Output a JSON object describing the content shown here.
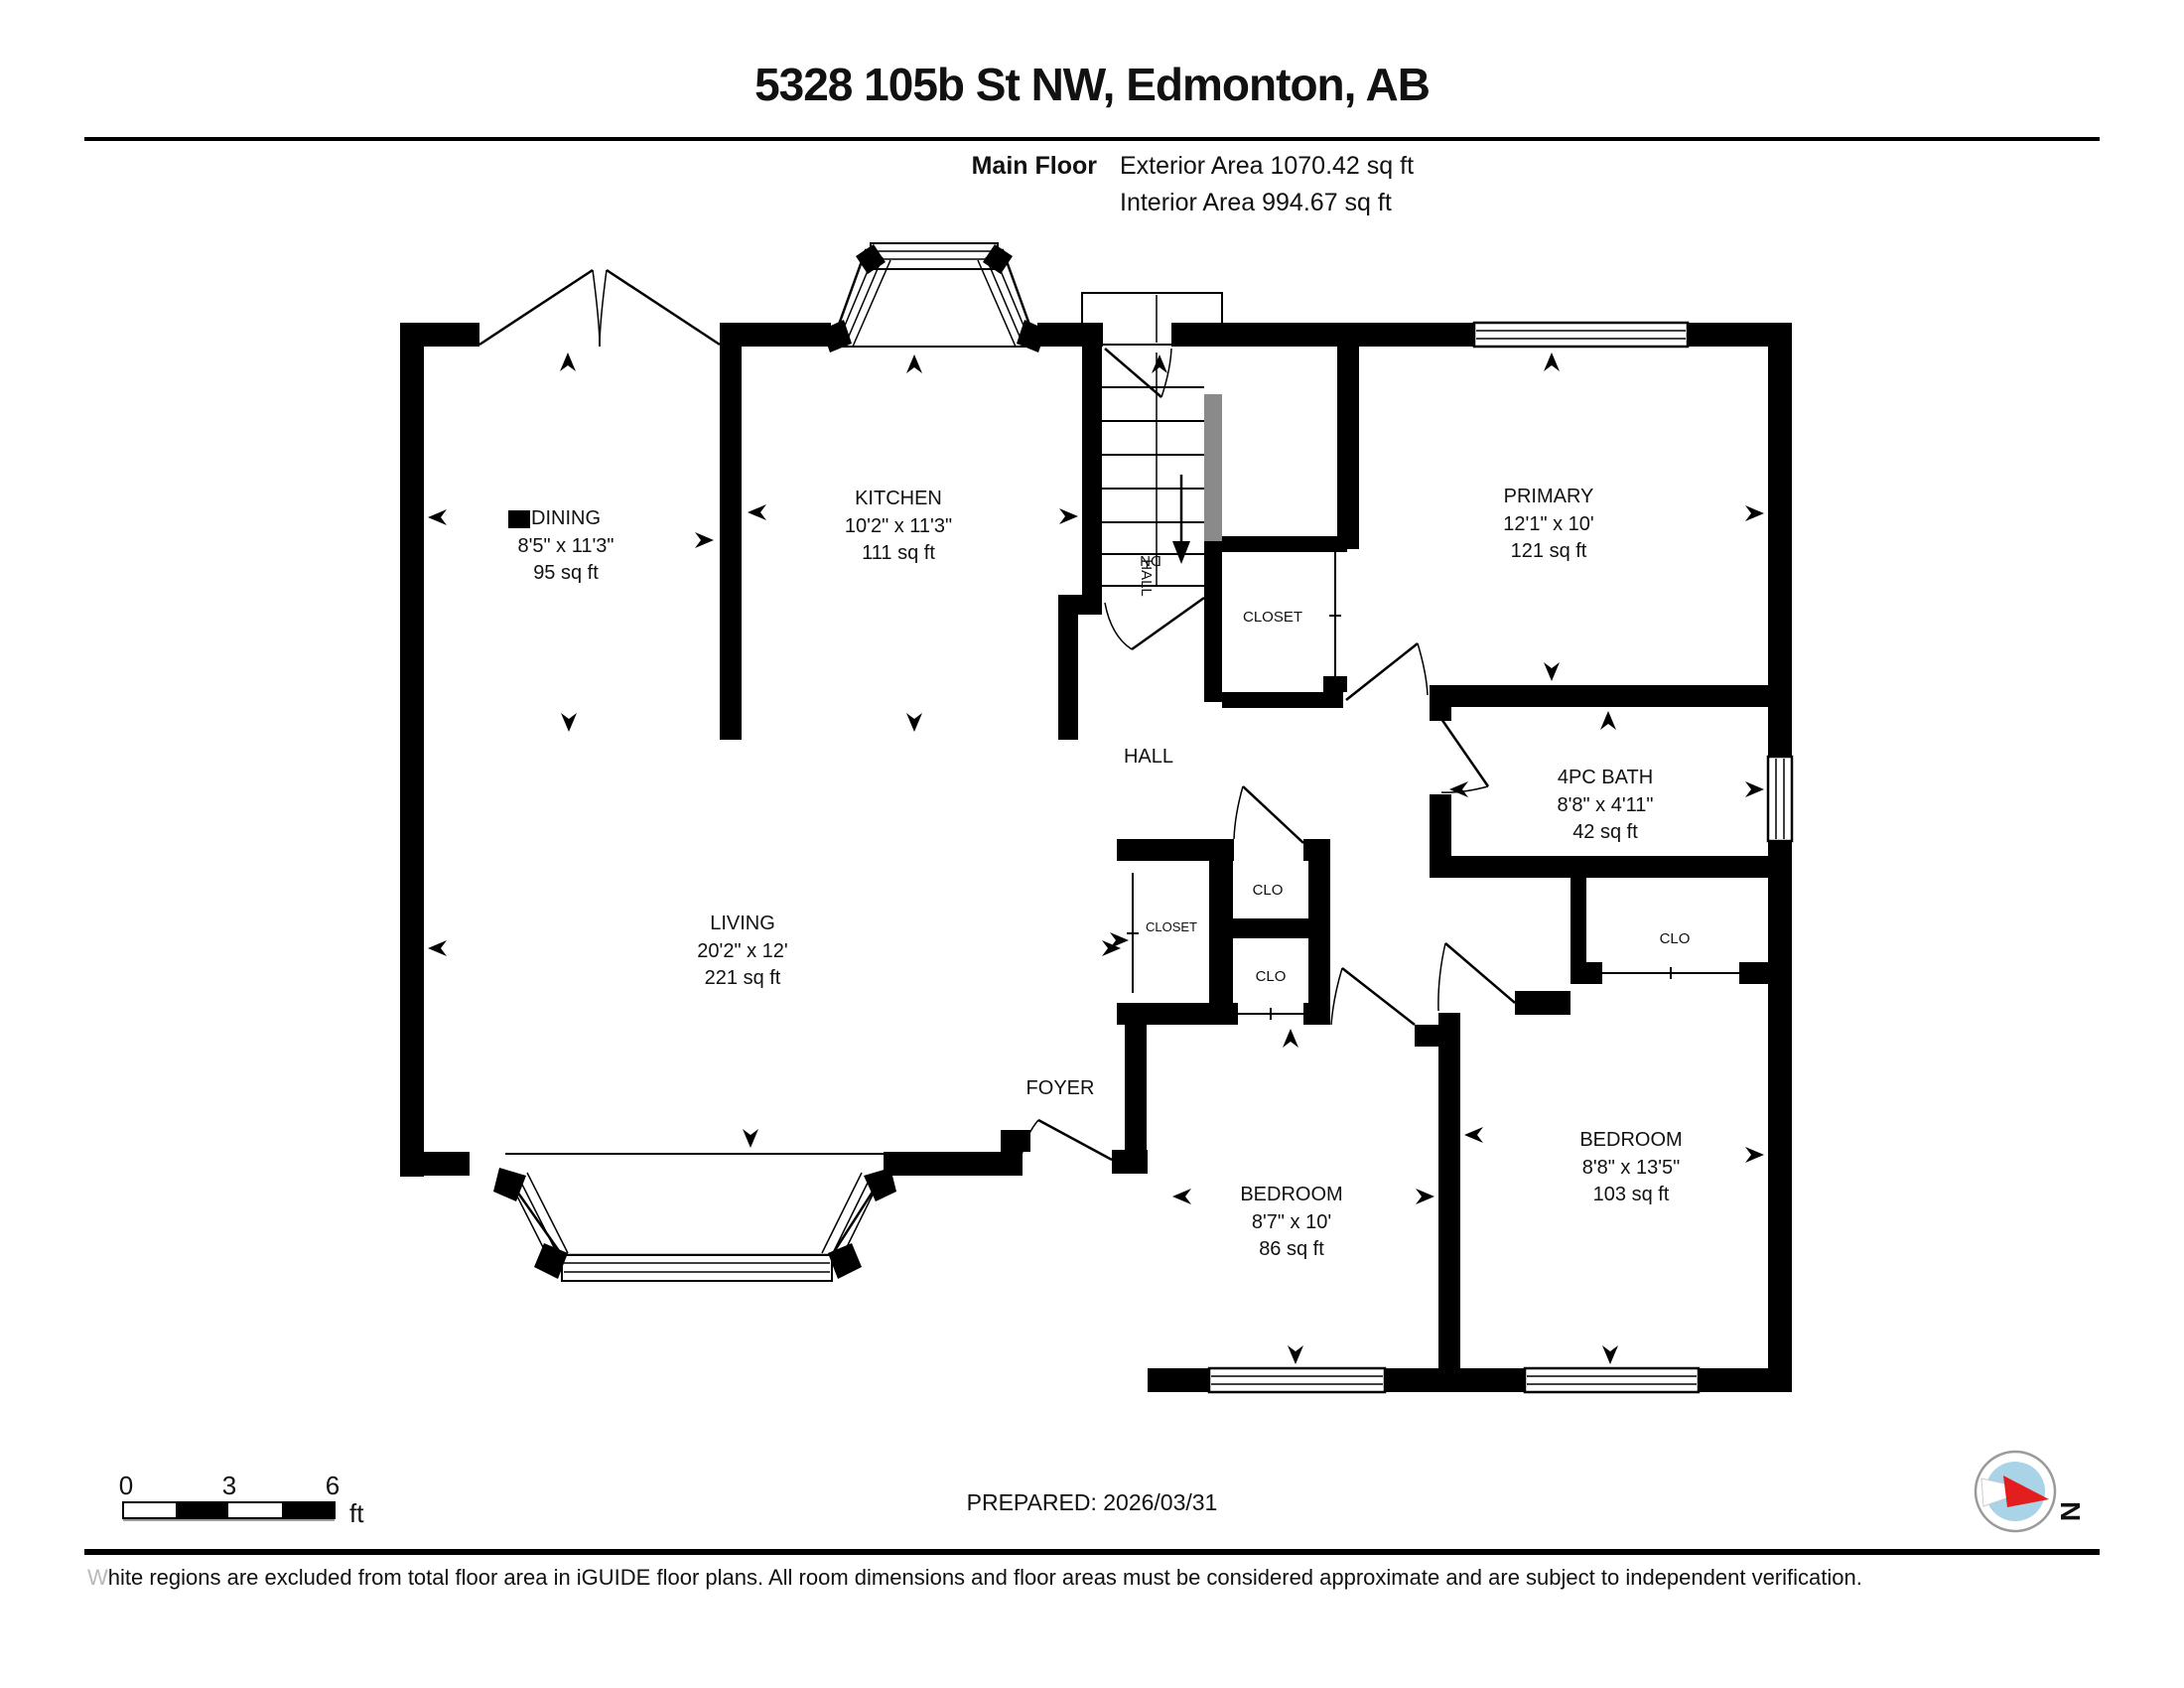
{
  "header": {
    "title": "5328 105b St NW, Edmonton, AB",
    "floor_label": "Main Floor",
    "exterior_area": "Exterior Area 1070.42 sq ft",
    "interior_area": "Interior Area 994.67 sq ft"
  },
  "rooms": {
    "dining": {
      "name": "DINING",
      "dims": "8'5\" x 11'3\"",
      "area": "95 sq ft"
    },
    "kitchen": {
      "name": "KITCHEN",
      "dims": "10'2\" x 11'3\"",
      "area": "111 sq ft"
    },
    "primary": {
      "name": "PRIMARY",
      "dims": "12'1\" x 10'",
      "area": "121 sq ft"
    },
    "living": {
      "name": "LIVING",
      "dims": "20'2\" x 12'",
      "area": "221 sq ft"
    },
    "bath": {
      "name": "4PC BATH",
      "dims": "8'8\" x 4'11\"",
      "area": "42 sq ft"
    },
    "bedroom_left": {
      "name": "BEDROOM",
      "dims": "8'7\" x 10'",
      "area": "86 sq ft"
    },
    "bedroom_right": {
      "name": "BEDROOM",
      "dims": "8'8\" x 13'5\"",
      "area": "103 sq ft"
    },
    "closet_primary": {
      "name": "CLOSET"
    },
    "closet_hall": {
      "name": "CLOSET"
    },
    "clo_top": {
      "name": "CLO"
    },
    "clo_bottom": {
      "name": "CLO"
    },
    "clo_bedroom": {
      "name": "CLO"
    },
    "hall": {
      "name": "HALL"
    },
    "hall_stairs": {
      "name": "HALL"
    },
    "foyer": {
      "name": "FOYER"
    },
    "stairs": {
      "name": "DN"
    }
  },
  "scale_bar": {
    "tick0": "0",
    "tick3": "3",
    "tick6": "6",
    "unit": "ft"
  },
  "footer": {
    "prepared": "PREPARED: 2026/03/31",
    "disclaimer": "White regions are excluded from total floor area in iGUIDE floor plans. All room dimensions and floor areas must be considered approximate and are subject to independent verification.",
    "compass_label": "N"
  },
  "colors": {
    "wall": "#000000",
    "compass_inner": "#a9d3e7",
    "compass_needle": "#e31e1e",
    "stair_gray": "#8a8a8a"
  }
}
